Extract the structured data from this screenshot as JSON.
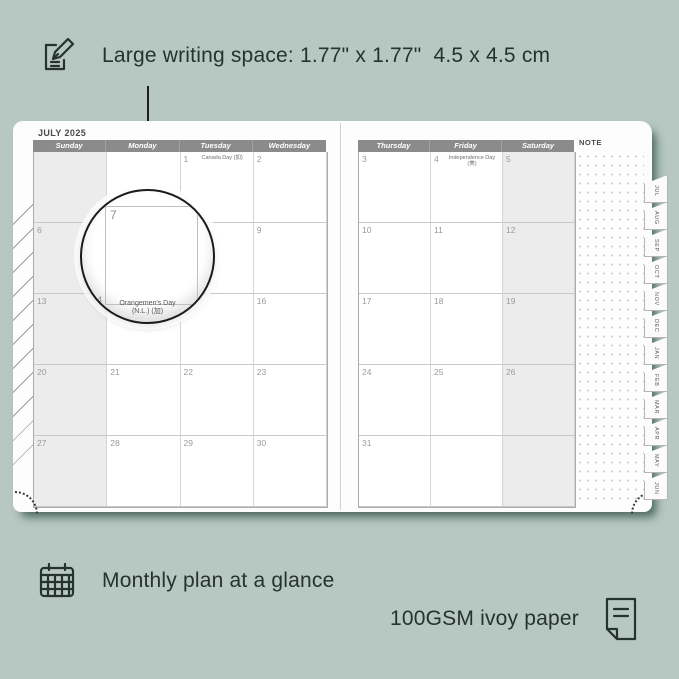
{
  "colors": {
    "background": "#b6c8c1",
    "annotation_text": "#26322e",
    "page": "#fdfdfd",
    "header_bar": "#8b8b8b",
    "weekend_shade": "#ececec",
    "shadow": "#38574f"
  },
  "annotations": {
    "top": {
      "icon": "pencil-note-icon",
      "text": "Large writing space: 1.77\" x 1.77\"  4.5 x 4.5 cm"
    },
    "bottom_left": {
      "icon": "calendar-grid-icon",
      "text": "Monthly plan at a glance"
    },
    "bottom_right": {
      "icon": "paper-sheet-icon",
      "text": "100GSM ivoy paper"
    }
  },
  "planner": {
    "month_title": "JULY 2025",
    "note_label": "NOTE",
    "left_page": {
      "day_headers": [
        "Sunday",
        "Monday",
        "Tuesday",
        "Wednesday"
      ],
      "weeks": [
        [
          {
            "day": ""
          },
          {
            "day": ""
          },
          {
            "day": "1",
            "holiday": "Canada Day (加)"
          },
          {
            "day": "2"
          }
        ],
        [
          {
            "day": "6"
          },
          {
            "day": "7"
          },
          {
            "day": "8"
          },
          {
            "day": "9"
          }
        ],
        [
          {
            "day": "13"
          },
          {
            "day": "14",
            "holiday": "Orangemen's Day (N.L.) (加)"
          },
          {
            "day": "15"
          },
          {
            "day": "16"
          }
        ],
        [
          {
            "day": "20"
          },
          {
            "day": "21"
          },
          {
            "day": "22"
          },
          {
            "day": "23"
          }
        ],
        [
          {
            "day": "27"
          },
          {
            "day": "28"
          },
          {
            "day": "29"
          },
          {
            "day": "30"
          }
        ]
      ]
    },
    "right_page": {
      "day_headers": [
        "Thursday",
        "Friday",
        "Saturday"
      ],
      "weeks": [
        [
          {
            "day": "3"
          },
          {
            "day": "4",
            "holiday": "Independence Day (美)"
          },
          {
            "day": "5"
          }
        ],
        [
          {
            "day": "10"
          },
          {
            "day": "11"
          },
          {
            "day": "12"
          }
        ],
        [
          {
            "day": "17"
          },
          {
            "day": "18"
          },
          {
            "day": "19"
          }
        ],
        [
          {
            "day": "24"
          },
          {
            "day": "25"
          },
          {
            "day": "26"
          }
        ],
        [
          {
            "day": "31"
          },
          {
            "day": ""
          },
          {
            "day": ""
          }
        ]
      ]
    },
    "month_tabs": [
      "JUL",
      "AUG",
      "SEP",
      "OCT",
      "NOV",
      "DEC",
      "JAN",
      "FEB",
      "MAR",
      "APR",
      "MAY",
      "JUN"
    ],
    "magnifier": {
      "day": "7",
      "below_day": "4",
      "holiday_line1": "Orangemen's Day",
      "holiday_line2": "(N.L.) (加)"
    }
  }
}
